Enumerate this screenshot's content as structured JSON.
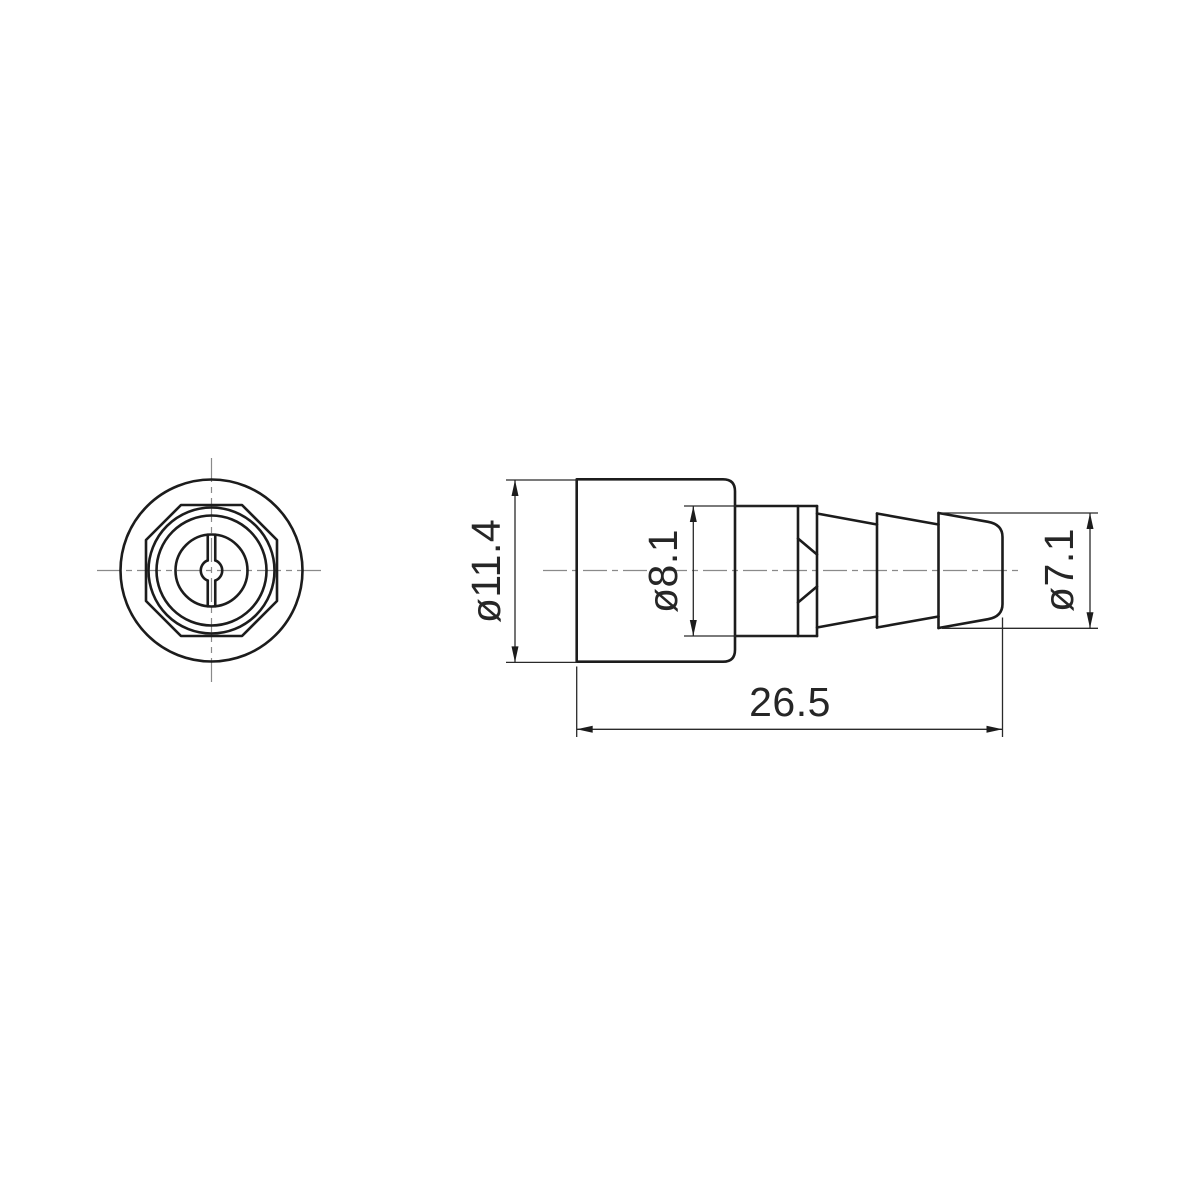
{
  "drawing": {
    "kind": "engineering-drawing",
    "background": "#ffffff",
    "line_color": "#1c1c1c",
    "centerline_color": "#8a8a8a",
    "dimensions": [
      {
        "id": "body-diameter",
        "label": "ø11.4"
      },
      {
        "id": "shaft-diameter",
        "label": "ø8.1"
      },
      {
        "id": "barb-diameter",
        "label": "ø7.1"
      },
      {
        "id": "overall-length",
        "label": "26.5"
      }
    ]
  }
}
